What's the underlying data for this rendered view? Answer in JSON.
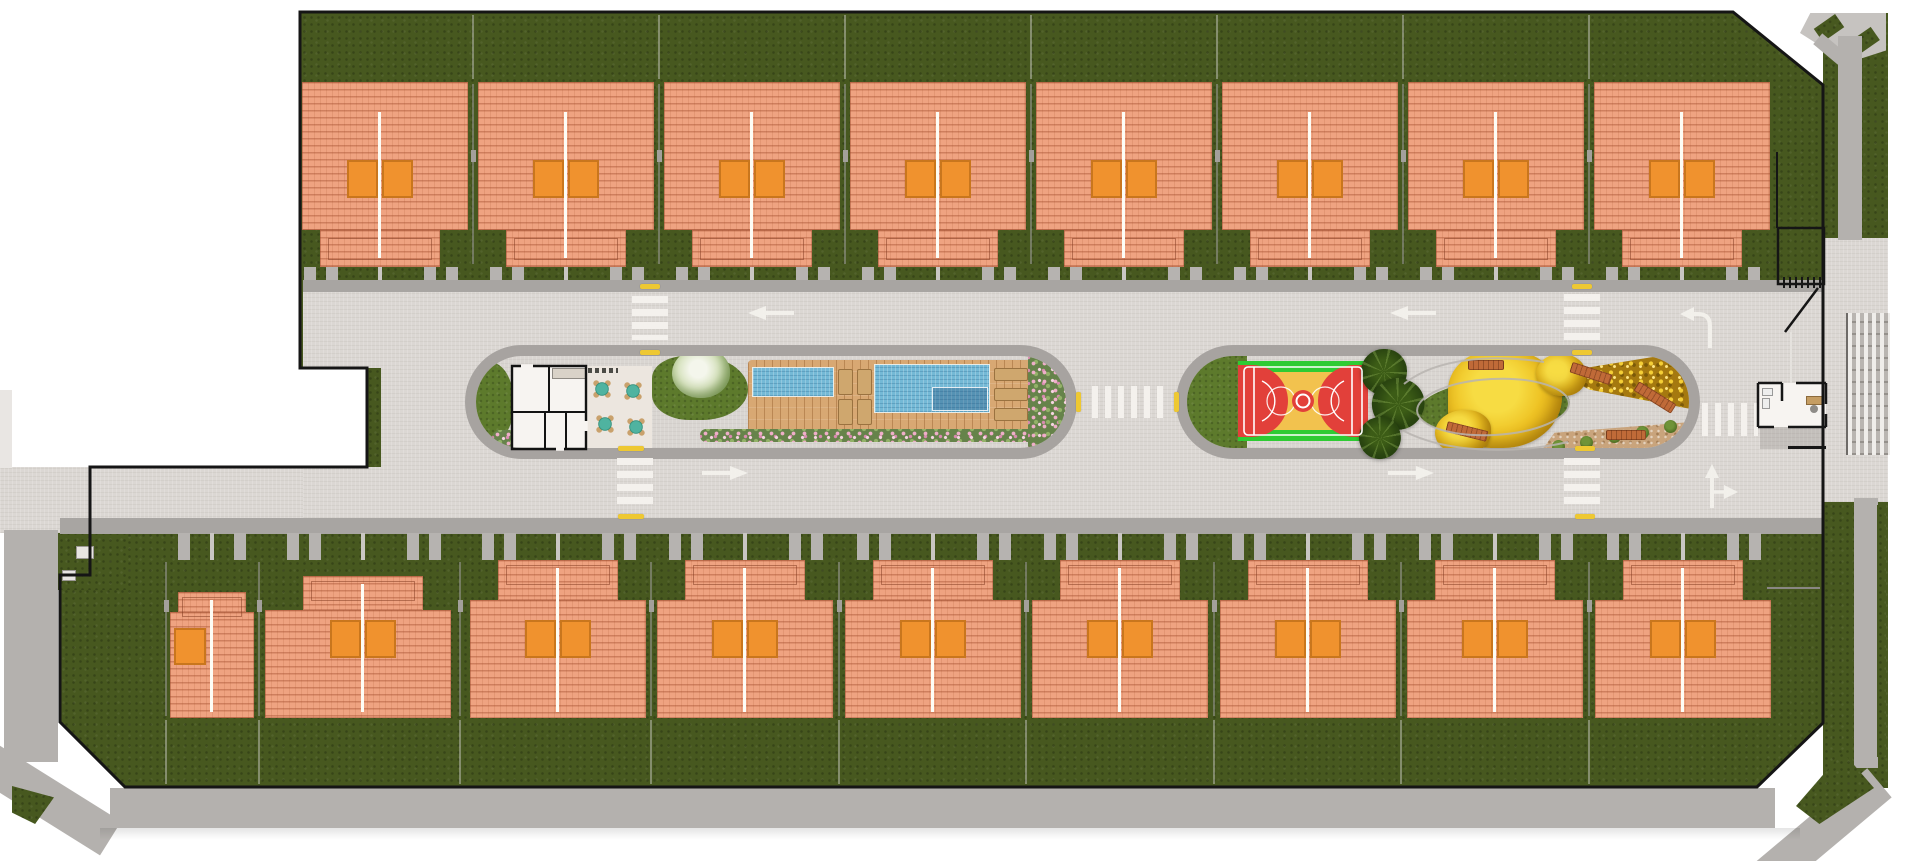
{
  "title": "Residential condominium master plan - top-down aerial site map, no visible text labels",
  "site": {
    "rows": [
      {
        "id": "north",
        "label": "North house row",
        "units": 8
      },
      {
        "id": "south",
        "label": "South house row",
        "units": 9
      }
    ],
    "total_units": 17,
    "amenities": [
      "clubhouse",
      "party terrace",
      "kids pool",
      "lap pool",
      "wood sun deck",
      "flower beds",
      "basketball court",
      "palm grove",
      "central garden",
      "garden benches",
      "gatehouse",
      "entrance gate"
    ],
    "road": {
      "median_islands": 2,
      "crosswalks": 6,
      "lane_arrows": [
        "west",
        "west",
        "east",
        "east",
        "left-turn",
        "straight-or-right"
      ],
      "edge_marker_color": "#eec832"
    }
  },
  "palette": {
    "background": "#ffffff",
    "grass_dark": "#47581f",
    "roof": "#efa381",
    "skylight": "#f0922e",
    "pavement": "#dbd7d3",
    "sidewalk": "#a8a5a2",
    "outer_road": "#b4b1ae",
    "pool_water": "#74b9d6",
    "deck_wood": "#d8a873",
    "court_green": "#2ecb33",
    "court_red": "#e2403a",
    "court_yellow": "#f2c24e",
    "flower_pink": "#e9a8c3",
    "tree_yellow": "#f3c91e",
    "bench_orange": "#c06a38",
    "boundary_line": "#151515",
    "crosswalk_white": "#f4f1ed"
  },
  "layout": {
    "top_houses": {
      "ridges": [
        380,
        566,
        752,
        938,
        1124,
        1310,
        1496,
        1682
      ],
      "clip_left": 302,
      "roof_top": 82,
      "roof_mid": 230,
      "roof_bottom": 267,
      "half_width": 88,
      "narrow_half": 60
    },
    "bottom_houses": {
      "regular_ridges": [
        558,
        745,
        933,
        1120,
        1308,
        1495,
        1683
      ],
      "roof_top": 560,
      "roof_mid": 600,
      "roof_bottom": 718,
      "half_width": 88,
      "narrow_half": 60,
      "small_units": [
        {
          "x": 170,
          "w": 84,
          "ridge": 212,
          "roof_top": 592,
          "roof_mid": 612,
          "skylight": "single"
        },
        {
          "x": 265,
          "w": 186,
          "ridge": 363,
          "roof_top": 576,
          "roof_mid": 610,
          "skylight": "double"
        }
      ]
    },
    "crosswalks": [
      {
        "x": 632,
        "y": 296,
        "w": 36,
        "h": 44,
        "dir": "h"
      },
      {
        "x": 617,
        "y": 458,
        "w": 36,
        "h": 48,
        "dir": "h"
      },
      {
        "x": 1564,
        "y": 294,
        "w": 36,
        "h": 48,
        "dir": "h"
      },
      {
        "x": 1564,
        "y": 458,
        "w": 36,
        "h": 48,
        "dir": "h"
      },
      {
        "x": 1092,
        "y": 386,
        "w": 76,
        "h": 32,
        "dir": "v"
      },
      {
        "x": 1702,
        "y": 403,
        "w": 56,
        "h": 33,
        "dir": "v"
      }
    ],
    "arrows": [
      {
        "x": 748,
        "y": 306,
        "type": "left"
      },
      {
        "x": 1390,
        "y": 306,
        "type": "left"
      },
      {
        "x": 702,
        "y": 466,
        "type": "right"
      },
      {
        "x": 1388,
        "y": 466,
        "type": "right"
      },
      {
        "x": 1680,
        "y": 300,
        "type": "turn-left"
      },
      {
        "x": 1698,
        "y": 464,
        "type": "straight-or-right"
      }
    ],
    "yellow_dashes": [
      {
        "x": 640,
        "y": 284,
        "w": 20,
        "h": 5
      },
      {
        "x": 640,
        "y": 350,
        "w": 20,
        "h": 5
      },
      {
        "x": 618,
        "y": 446,
        "w": 26,
        "h": 5
      },
      {
        "x": 618,
        "y": 514,
        "w": 26,
        "h": 5
      },
      {
        "x": 1572,
        "y": 284,
        "w": 20,
        "h": 5
      },
      {
        "x": 1572,
        "y": 350,
        "w": 20,
        "h": 5
      },
      {
        "x": 1575,
        "y": 446,
        "w": 20,
        "h": 5
      },
      {
        "x": 1575,
        "y": 514,
        "w": 20,
        "h": 5
      },
      {
        "x": 1076,
        "y": 392,
        "w": 5,
        "h": 20
      },
      {
        "x": 1174,
        "y": 392,
        "w": 5,
        "h": 20
      }
    ]
  }
}
